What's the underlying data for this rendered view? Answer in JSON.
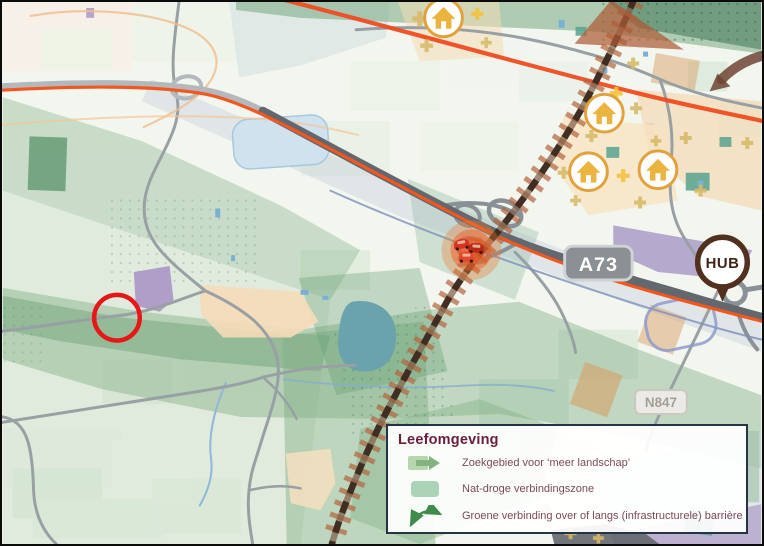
{
  "map_labels": {
    "motorway_shield": "A73",
    "provincial_road_shield": "N847",
    "hub_pin": "HUB"
  },
  "legend": {
    "title": "Leefomgeving",
    "items": [
      {
        "icon": "zoekgebied-arrow-icon",
        "label": "Zoekgebied voor ‘meer landschap’"
      },
      {
        "icon": "nat-droge-zone-swatch-icon",
        "label": "Nat-droge verbindingszone"
      },
      {
        "icon": "groene-verbinding-arrow-icon",
        "label": "Groene verbinding over of langs (infrastructurele) barrière"
      }
    ]
  },
  "map": {
    "icons": {
      "houses": [
        [
          444,
          16
        ],
        [
          606,
          112
        ],
        [
          590,
          171
        ],
        [
          660,
          169
        ]
      ],
      "pluses": [
        [
          420,
          17,
          15,
          0
        ],
        [
          478,
          12,
          12,
          1
        ],
        [
          427,
          44,
          13,
          0
        ],
        [
          487,
          41,
          11,
          0
        ],
        [
          635,
          62,
          12,
          0
        ],
        [
          618,
          92,
          13,
          1
        ],
        [
          638,
          107,
          12,
          0
        ],
        [
          593,
          135,
          12,
          0
        ],
        [
          688,
          137,
          12,
          0
        ],
        [
          658,
          140,
          11,
          0
        ],
        [
          750,
          142,
          12,
          0
        ],
        [
          565,
          172,
          12,
          0
        ],
        [
          625,
          175,
          13,
          1
        ],
        [
          703,
          190,
          12,
          0
        ],
        [
          577,
          200,
          11,
          0
        ],
        [
          642,
          202,
          12,
          0
        ],
        [
          523,
          490,
          11,
          0
        ],
        [
          548,
          512,
          12,
          0
        ],
        [
          572,
          535,
          12,
          0
        ],
        [
          600,
          540,
          11,
          0
        ]
      ],
      "cars": [
        [
          462,
          243,
          -10
        ],
        [
          477,
          247,
          4
        ],
        [
          467,
          256,
          0
        ]
      ]
    },
    "annotations": {
      "red_circle": {
        "x": 115,
        "y": 318,
        "r": 23
      },
      "congestion_glow": {
        "x": 472,
        "y": 250
      }
    },
    "colors": {
      "highway_orange": "#f3571f",
      "railway_brown": "#3b2a20",
      "hatch_rust": "#b4643e",
      "plus_bright": "#f2c238",
      "plus_olive": "#d6b968",
      "house_gold": "#eab43f",
      "red_annotation": "#e61717",
      "hub_brown": "#51301f",
      "legend_title_color": "#6b1d3d",
      "legend_text_color": "#7c4a55"
    }
  }
}
